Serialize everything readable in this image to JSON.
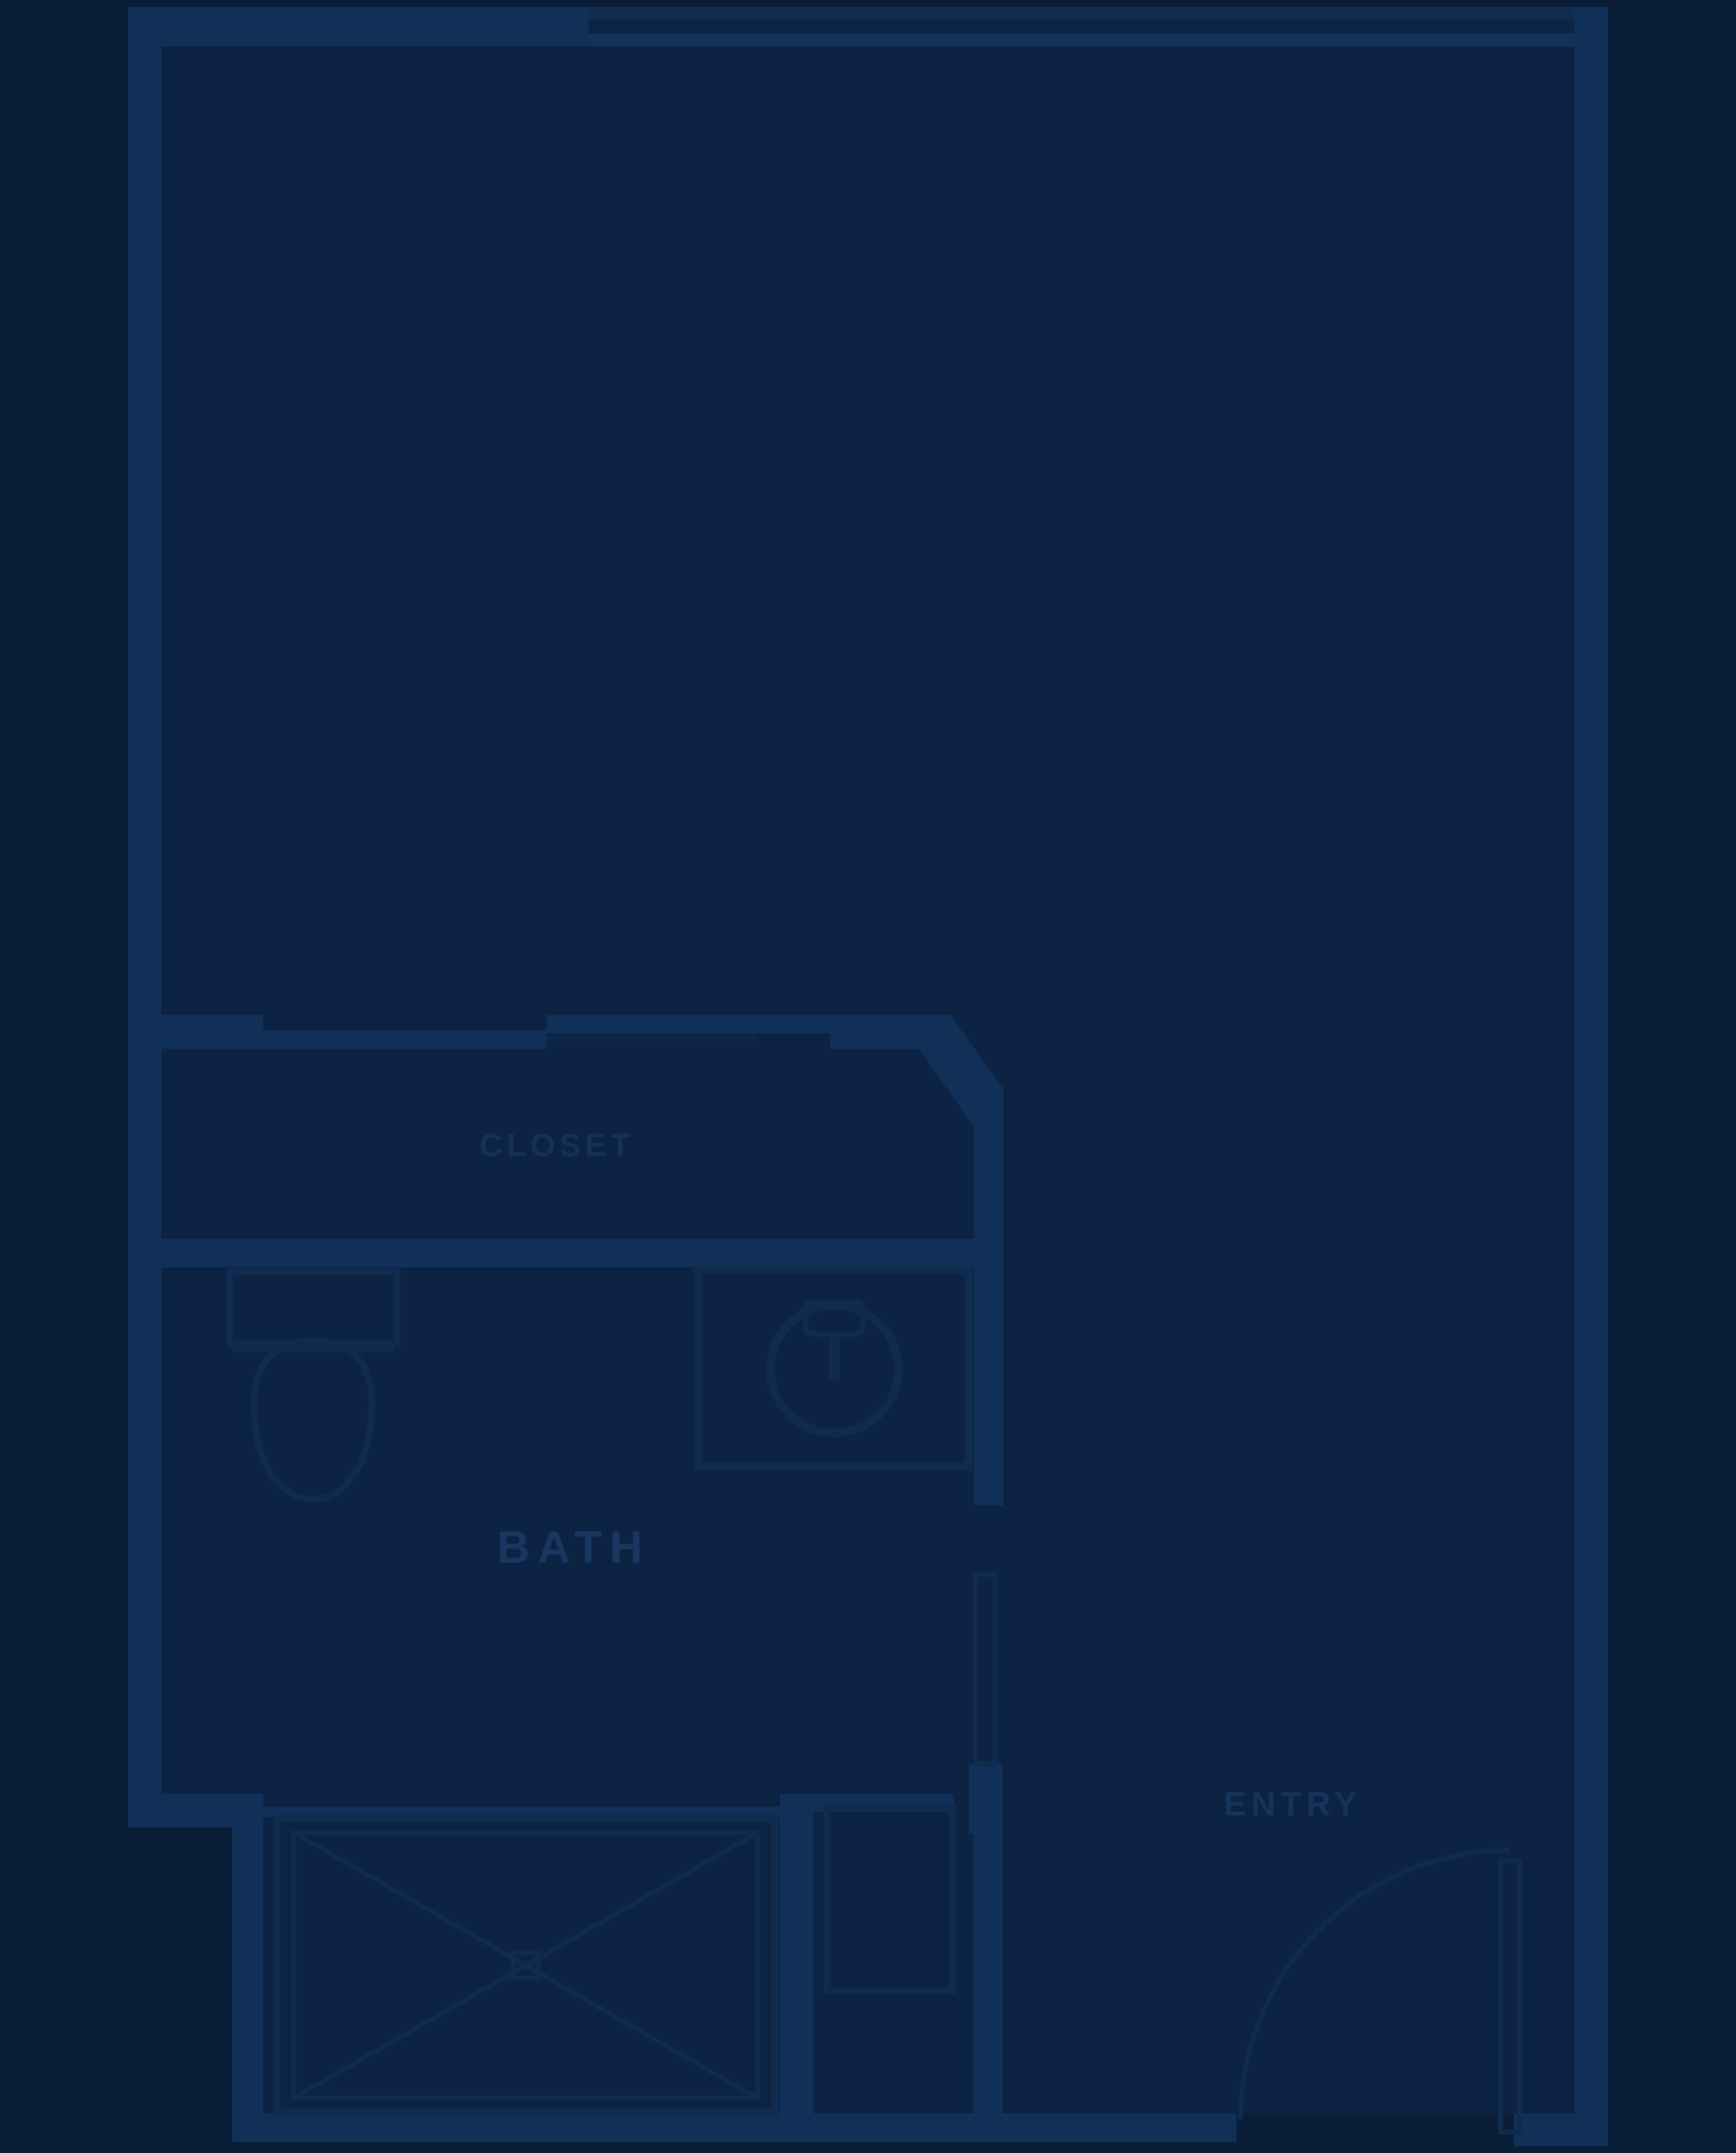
{
  "plan": {
    "title": "studio-apartment-floor-plan",
    "labels": {
      "closet": "CLOSET",
      "bath": "BATH",
      "entry": "ENTRY"
    },
    "rooms": [
      {
        "name": "main-room",
        "label": ""
      },
      {
        "name": "closet",
        "label": "CLOSET"
      },
      {
        "name": "bath",
        "label": "BATH"
      },
      {
        "name": "entry",
        "label": "ENTRY"
      }
    ],
    "fixtures": [
      "toilet",
      "vanity-sink",
      "shower-box-x",
      "utility-cabinet",
      "closet-sliding-doors",
      "bath-door",
      "entry-door-swing",
      "window-top-wall"
    ],
    "colors": {
      "background": "#0a1e38",
      "interior": "#0d2343",
      "wall": "#103058",
      "line": "#0f2b4e",
      "label": "#1a3a64"
    }
  }
}
